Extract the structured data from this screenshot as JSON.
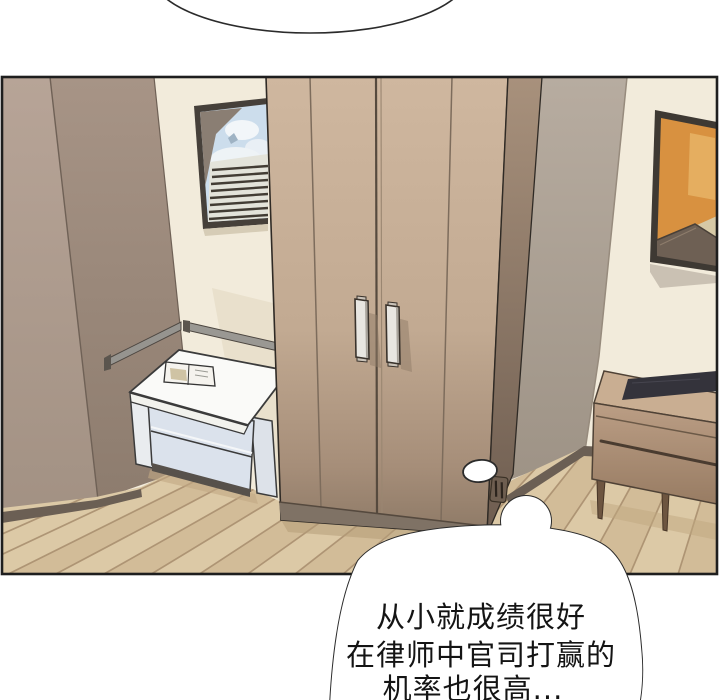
{
  "scene": {
    "type": "comic-panel",
    "setting": "bedroom interior with wardrobe, window bench, dresser and wall art"
  },
  "speech_bubble": {
    "lines": [
      "从小就成绩很好",
      "在律师中官司打赢的",
      "机率也很高..."
    ]
  },
  "colors": {
    "page_bg": "#ffffff",
    "panel_border": "#1e1e1e",
    "wall_cream": "#f2ebdb",
    "wall_left_light": "#b5a295",
    "wall_left_dark": "#a08f81",
    "wall_right_gray": "#b5aa9e",
    "wardrobe_front": "#c4ac94",
    "wardrobe_side": "#95816e",
    "floor_base": "#dcc9a6",
    "floor_stripe": "#c8af8a",
    "floor_seam": "#aa9070",
    "baseboard": "#6b5f54",
    "bench_top": "#fafaf8",
    "bench_drawer": "#dbe2ec",
    "dresser_wood": "#b49780",
    "dresser_slab": "#34333b",
    "art_orange": "#d89140",
    "art_roof": "#6e6054",
    "sky_blue": "#ccddec",
    "rail_gray": "#98968f",
    "bubble_fill": "#ffffff",
    "bubble_stroke": "#2b2b2b",
    "text_color": "#141414"
  }
}
